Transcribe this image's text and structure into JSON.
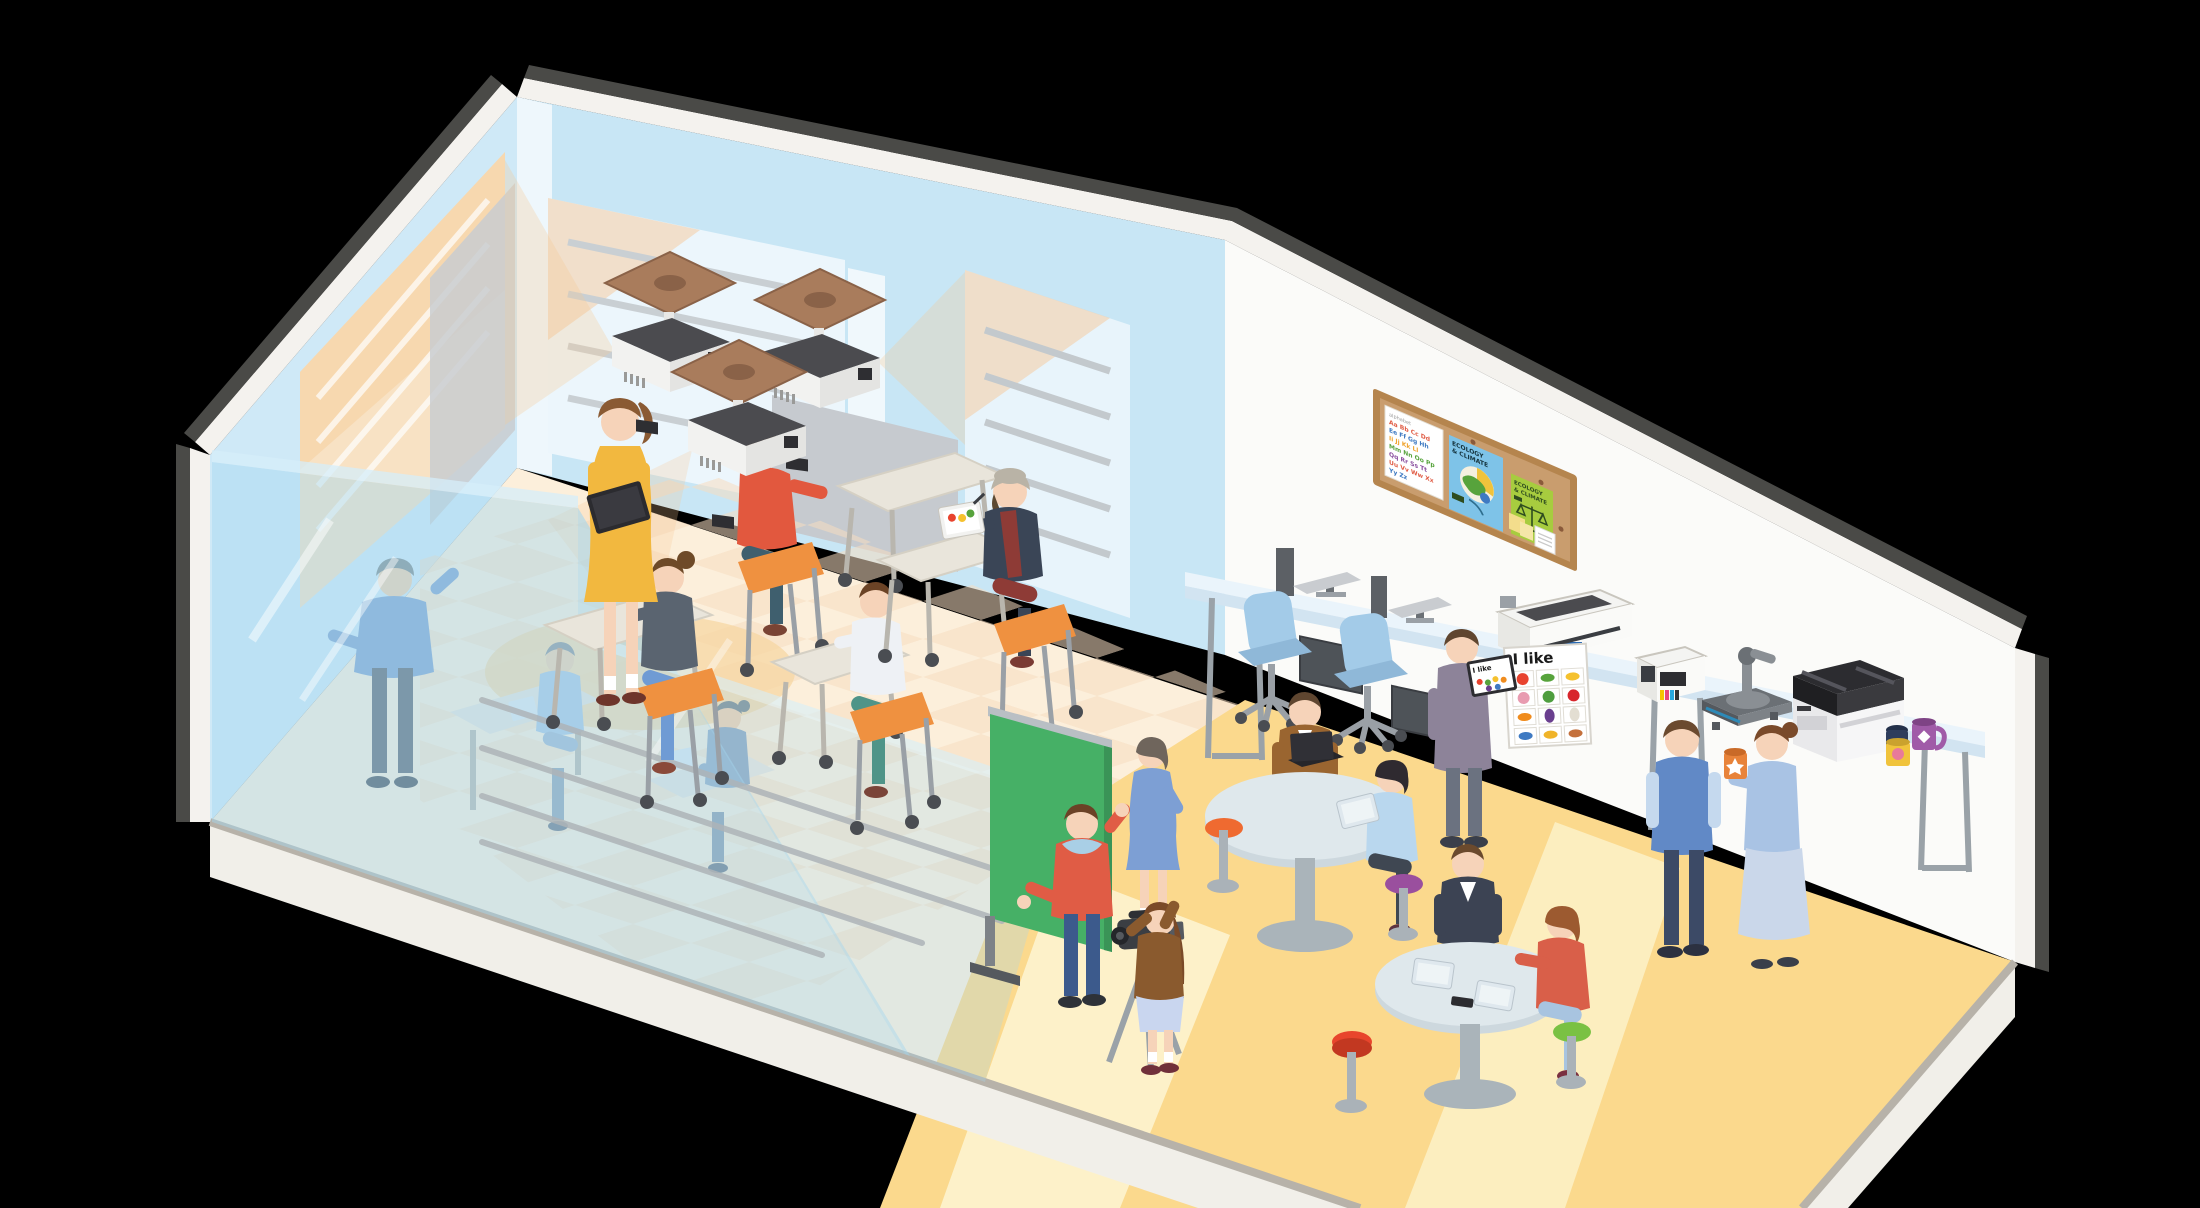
{
  "scene": {
    "description": "Isometric cutaway illustration of a school learning space: glass-partitioned classroom with ceiling projectors and students at wheeled desks, a media corner with green screen and video camera, round discussion tables with tablets, a computer and print station with large-format printer, ink printer, heat press, copier and printed mugs, and a cork bulletin board.",
    "background": "#000000"
  },
  "labels": {
    "poster_title": "I like",
    "ecology_line1": "ECOLOGY",
    "ecology_line2": "& CLIMATE"
  },
  "alphabet": {
    "rows": [
      "Aa Bb Cc Dd",
      "Ee Ff Gg Hh",
      "Ii Jj Kk Ll",
      "Mm Nn Oo Pp",
      "Qq Rr Ss Tt",
      "Uu Vv Ww Xx",
      "Yy Zz"
    ],
    "row_colors": [
      "#e05c45",
      "#3f7ac2",
      "#f0a32e",
      "#57a33c",
      "#8a4f9e",
      "#e05c45",
      "#3f7ac2"
    ]
  },
  "poster": {
    "title": "I like",
    "fruit_names": [
      "tomato",
      "cucumber",
      "banana",
      "peach",
      "green pepper",
      "apple",
      "carrot",
      "eggplant",
      "radish",
      "fish",
      "bananas",
      "sausage"
    ],
    "fruit_colors": [
      "#e8432e",
      "#57a33c",
      "#f5c12e",
      "#e89bb0",
      "#4f9e3f",
      "#d8262c",
      "#f08c1e",
      "#6a3f8f",
      "#e3ded2",
      "#3f7ac2",
      "#f0b429",
      "#c4703c"
    ]
  },
  "palette": {
    "wall_blue": "#c9e6f5",
    "wall_white": "#fbfbf9",
    "roof_rim": "#4a4a47",
    "floor_cream": "#fcefdb",
    "floor_checker": "#f6dcc0",
    "floor_yellow": "#fbd98d",
    "floor_lane": "#fdf2cc",
    "glass_blue": "#a4d7ef",
    "glow_orange": "#f6c995",
    "green_screen": "#46b066",
    "seat_orange": "#ef9140",
    "desk_top": "#e9e5db",
    "counter_top": "#eaf4fb",
    "chair_blue": "#a3cbe8",
    "cork": "#c99d6e",
    "wood_frame": "#b5854e",
    "skin": "#f6d3b9"
  },
  "people": [
    {
      "id": "teacher-yellow",
      "desc": "teacher in yellow dress holding black tablet"
    },
    {
      "id": "presenter-blue",
      "desc": "teacher in blue presenting behind glass partition"
    },
    {
      "id": "glass-student",
      "desc": "student with tablet at desk behind glass"
    },
    {
      "id": "glass-student-ponytail",
      "desc": "ponytail student with tablet behind glass"
    },
    {
      "id": "student-bun",
      "desc": "student with hair bun, gray top, blue pants"
    },
    {
      "id": "student-red-sweater",
      "desc": "student in red-orange sweater at desk"
    },
    {
      "id": "student-light-shirt",
      "desc": "student in light shirt and teal pants at desk"
    },
    {
      "id": "student-hat-tablet",
      "desc": "student in beanie and maroon apron drawing on tablet"
    },
    {
      "id": "man-gray-sweater-tablet",
      "desc": "man in gray-purple sweater holding tablet with poster preview"
    },
    {
      "id": "man-brown-cardigan-laptop",
      "desc": "man in brown cardigan with laptop at round table"
    },
    {
      "id": "woman-black-hair-tablet",
      "desc": "black-haired woman with tablet on purple stool"
    },
    {
      "id": "man-navy-cardigan",
      "desc": "man in navy cardigan at round table"
    },
    {
      "id": "woman-coral-top",
      "desc": "auburn-haired woman in coral top on green stool"
    },
    {
      "id": "man-blue-vest",
      "desc": "man in blue vest standing at print station"
    },
    {
      "id": "woman-light-blue-mug",
      "desc": "woman in light blue holding printed orange mug"
    },
    {
      "id": "girl-camera-operator",
      "desc": "girl in brown cardigan filming with camera on tripod"
    },
    {
      "id": "boy-red-hoodie",
      "desc": "boy in red hoodie presenting at green screen"
    },
    {
      "id": "girl-blue-dress",
      "desc": "girl in blue dress at green screen"
    }
  ],
  "equipment": [
    {
      "id": "ceiling-projector",
      "count": 3
    },
    {
      "id": "desktop-computer",
      "count": 2
    },
    {
      "id": "large-format-printer",
      "count": 1
    },
    {
      "id": "ink-tank-printer",
      "count": 1
    },
    {
      "id": "heat-press",
      "count": 1
    },
    {
      "id": "copier",
      "count": 1
    },
    {
      "id": "video-camera-tripod",
      "count": 1
    },
    {
      "id": "green-screen",
      "count": 1
    },
    {
      "id": "printed-mug",
      "count": 3
    },
    {
      "id": "bulletin-board",
      "count": 1
    }
  ],
  "furniture": [
    {
      "id": "student-desk",
      "count": 4
    },
    {
      "id": "caster-chair-orange",
      "count": 4
    },
    {
      "id": "office-chair-blue",
      "count": 2
    },
    {
      "id": "round-table",
      "count": 2
    },
    {
      "id": "stool",
      "count": 4
    },
    {
      "id": "counter-table",
      "count": 1
    }
  ]
}
